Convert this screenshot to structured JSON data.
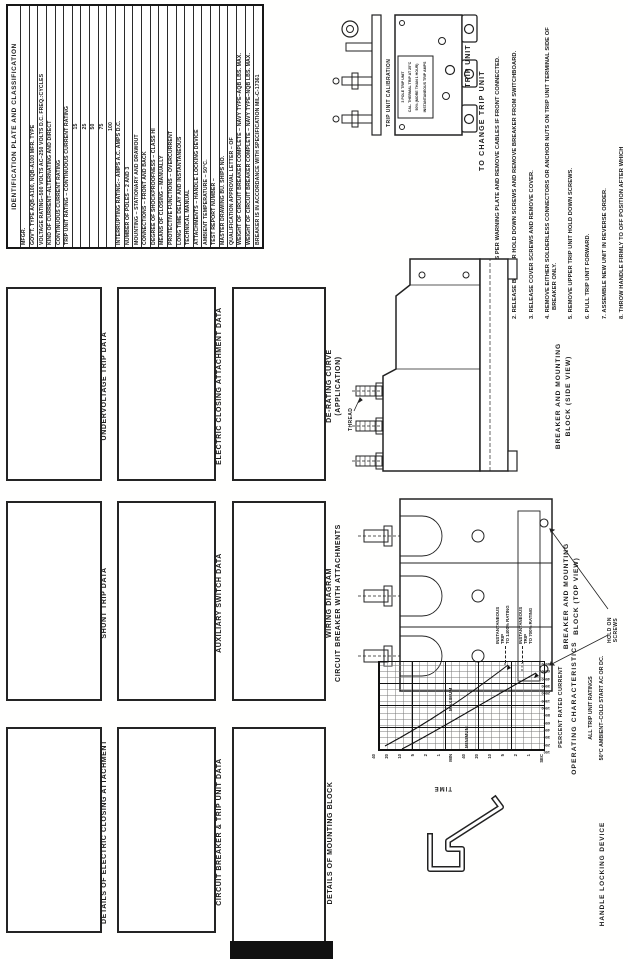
{
  "id_table": {
    "title": "IDENTIFICATION PLATE AND CLASSIFICATION",
    "rows": [
      {
        "t": "MFGR."
      },
      {
        "t": "GOV'T. TYPE AQB-A100, NQB-A100   MFR. TYPE"
      },
      {
        "t": "VOLTAGE RATING–500 VOLTS AC–250 VOLTS D.C.  FREQ.:CYCLES"
      },
      {
        "t": "KIND OF CURRENT–ALTERNATING AND DIRECT"
      },
      {
        "t": "CONTINUOUS CURRENT RATING"
      },
      {
        "t": "TRIP UNIT RATING – CONTINUOUS CURRENT RATING"
      },
      {
        "t": "15",
        "center": true
      },
      {
        "t": "25",
        "center": true
      },
      {
        "t": "50",
        "center": true
      },
      {
        "t": "75",
        "center": true
      },
      {
        "t": "100",
        "center": true
      },
      {
        "t": "INTERRUPTING RATING:–    AMPS A.C.    AMPS D.C."
      },
      {
        "t": "NUMBER OF POLES – 2 AND 3"
      },
      {
        "t": "MOUNTING – STATIONARY AND DRAWOUT"
      },
      {
        "t": "CONNECTIONS – FRONT AND BACK"
      },
      {
        "t": "DEGREE OF SHOCKPROOFNESS – CLASS HI"
      },
      {
        "t": "MEANS OF CLOSING – MANUALLY"
      },
      {
        "t": "PROTECTIVE FUNCTIONS – OVERCURRENT"
      },
      {
        "t": "LONG TIME DELAY AND INSTANTANEOUS"
      },
      {
        "t": "TECHNICAL MANUAL"
      },
      {
        "t": "ATTACHMENTS – HANDLE LOCKING DEVICE"
      },
      {
        "t": "AMBIENT TEMPERATURE – 50°C."
      },
      {
        "t": "TEST REPORT NUMBER –"
      },
      {
        "t": "MASTER DRAWING              BU. SHIPS NO."
      },
      {
        "t": "QUALIFICATION APPROVAL LETTER –           OF"
      },
      {
        "t": "WEIGHT OF CIRCUIT BREAKER COMPLETE – NAVY TYPE–AQB  LBS. MAX."
      },
      {
        "t": "WEIGHT OF CIRCUIT BREAKER COMPLETE – NAVY TYPE–NQB  LBS. MAX."
      },
      {
        "t": "BREAKER IS IN ACCORDANCE WITH SPECIFICATION MIL-C-17361"
      }
    ]
  },
  "data_boxes": [
    {
      "label": "DETAILS OF ELECTRIC CLOSING ATTACHMENT",
      "label2": ""
    },
    {
      "label": "CIRCUIT BREAKER & TRIP UNIT DATA",
      "label2": ""
    },
    {
      "label": "DETAILS OF MOUNTING BLOCK",
      "label2": ""
    },
    {
      "label": "SHUNT TRIP DATA",
      "label2": ""
    },
    {
      "label": "AUXILIARY SWITCH DATA",
      "label2": ""
    },
    {
      "label": "WIRING DIAGRAM",
      "label2": "CIRCUIT BREAKER WITH ATTACHMENTS"
    },
    {
      "label": "UNDERVOLTAGE TRIP DATA",
      "label2": ""
    },
    {
      "label": "ELECTRIC CLOSING ATTACHMENT DATA",
      "label2": ""
    },
    {
      "label": "DE-RATING CURVE",
      "label2": "(APPLICATION)"
    }
  ],
  "trip_unit": {
    "caption": "TRIP UNIT",
    "calibration_label": "TRIP UNIT CALIBRATION",
    "nameplate": [
      "3 POLE TRIP UNIT",
      "CAL. THERMAL TRIP AT 25°C",
      "50% (MORE THAN 1 HOUR)",
      "INSTANTANEOUS TRIP AMPS"
    ]
  },
  "change_instructions": {
    "title": "TO CHANGE TRIP UNIT",
    "steps": [
      "1. OPEN BREAKER AS PER WARNING PLATE AND REMOVE CABLES IF FRONT CONNECTED.",
      "2. RELEASE BREAKER HOLD DOWN SCREWS AND REMOVE BREAKER FROM SWITCHBOARD.",
      "3. RELEASE COVER SCREWS AND REMOVE COVER.",
      "4. REMOVE EITHER SOLDERLESS CONNECTORS OR ANCHOR NUTS ON TRIP UNIT TERMINAL SIDE OF BREAKER ONLY.",
      "5. REMOVE UPPER TRIP UNIT HOLD DOWN SCREWS.",
      "6. PULL TRIP UNIT FORWARD.",
      "7. ASSEMBLE NEW UNIT IN REVERSE ORDER.",
      "8. THROW HANDLE FIRMLY TO OFF POSITION AFTER WHICH"
    ]
  },
  "side_view": {
    "caption1": "BREAKER AND MOUNTING",
    "caption2": "BLOCK (SIDE VIEW)",
    "thread_label": "THREAD"
  },
  "top_view": {
    "caption1": "BREAKER AND MOUNTING",
    "caption2": "BLOCK (TOP VIEW)",
    "screws1": "HOLD ON",
    "screws2": "SCREWS"
  },
  "handle_lock": {
    "caption": "HANDLE LOCKING DEVICE"
  },
  "chart_data": {
    "type": "line",
    "title": "OPERATING CHARACTERISTICS",
    "subtitle1": "ALL TRIP UNIT RATINGS",
    "subtitle2": "50°C AMBIENT–COLD START AC OR DC.",
    "xlabel": "PERCENT RATED CURRENT",
    "ylabel": "TIME",
    "x_scale": "log",
    "y_scale": "log",
    "x_ticks": [
      "100",
      "200",
      "300",
      "400",
      "600",
      "800",
      "1000",
      "1500",
      "2000",
      "3000",
      "4000",
      "6000",
      "8000"
    ],
    "y_ticks": [
      "40",
      "20",
      "10",
      "5",
      "2",
      "1",
      "MIN",
      "40",
      "20",
      "10",
      "5",
      "2",
      "1",
      "SEC"
    ],
    "grid": true,
    "series": [
      {
        "name": "MINIMUM",
        "points_percent_seconds": [
          [
            150,
            2400
          ],
          [
            300,
            240
          ],
          [
            600,
            40
          ],
          [
            800,
            12
          ]
        ]
      },
      {
        "name": "MAXIMUM",
        "points_percent_seconds": [
          [
            150,
            7200
          ],
          [
            300,
            900
          ],
          [
            600,
            150
          ],
          [
            1000,
            40
          ]
        ]
      }
    ],
    "callouts": [
      {
        "line1": "INSTANTANEOUS",
        "line2": "TRIP",
        "line3": "TO 1400% RATING"
      },
      {
        "line1": "INSTANTANEOUS",
        "line2": "TRIP",
        "line3": "TO 700% RATING"
      }
    ]
  }
}
